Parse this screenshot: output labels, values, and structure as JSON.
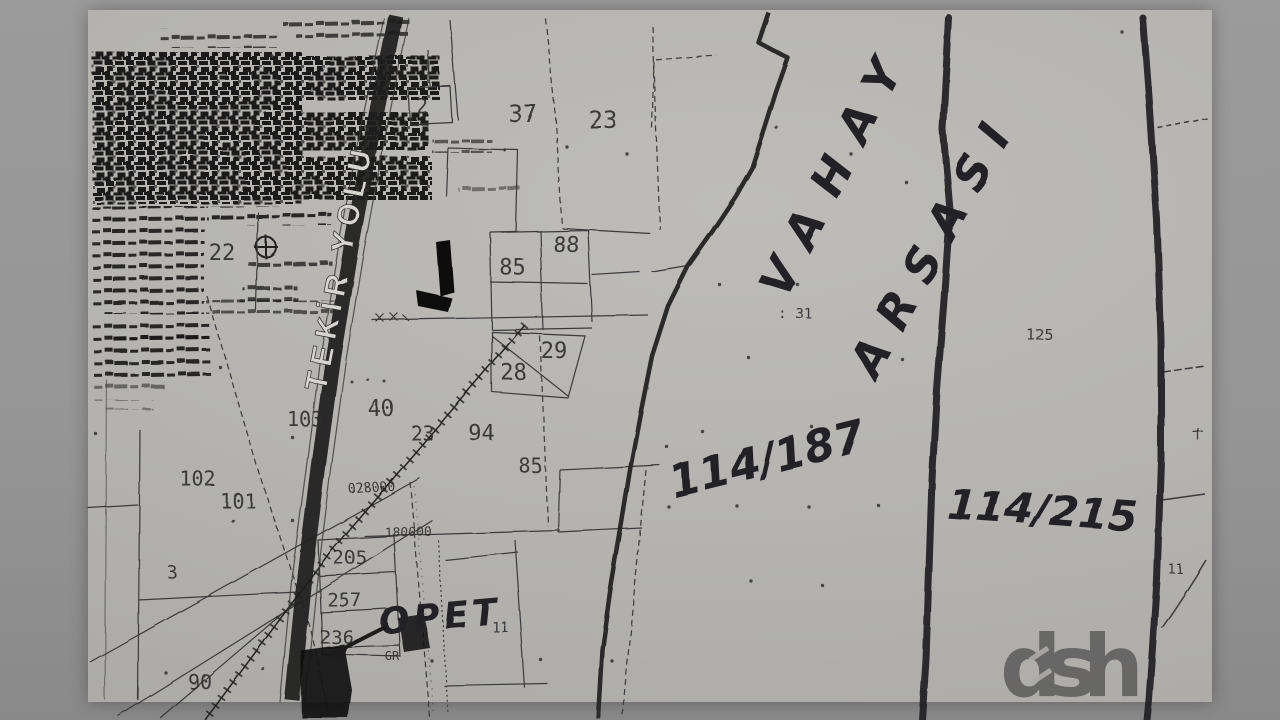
{
  "colors": {
    "backdrop": "#959595",
    "paper": "#b4b3b0",
    "ink": "#2d2d2d",
    "pen": "#222226"
  },
  "road": {
    "name": "TEKİR YOLU"
  },
  "handwriting": {
    "area_word1": "VAHAY",
    "area_word2": "ARSASI",
    "parcel_ratio_left": "114/187",
    "parcel_ratio_right": "114/215",
    "station": "OPET"
  },
  "parcel_numbers": {
    "n2": "2",
    "n37": "37",
    "n23a": "23",
    "n22": "22",
    "n88": "88",
    "n85a": "85",
    "n31": ": 31",
    "n125": "125",
    "n29": "29",
    "n28": "28",
    "n40": "40",
    "n23b": "23",
    "n94": "94",
    "n103": "103",
    "n85b": "85",
    "n102": "102",
    "n101": "101",
    "n3": "3",
    "n205": "205",
    "n257": "257",
    "n236": "236",
    "n90": "90",
    "n11a": "11",
    "nGR": "GR",
    "n11b": "11"
  },
  "stamps": {
    "s1": "028000",
    "s2": "180000"
  },
  "watermark": {
    "text": "dsh"
  }
}
